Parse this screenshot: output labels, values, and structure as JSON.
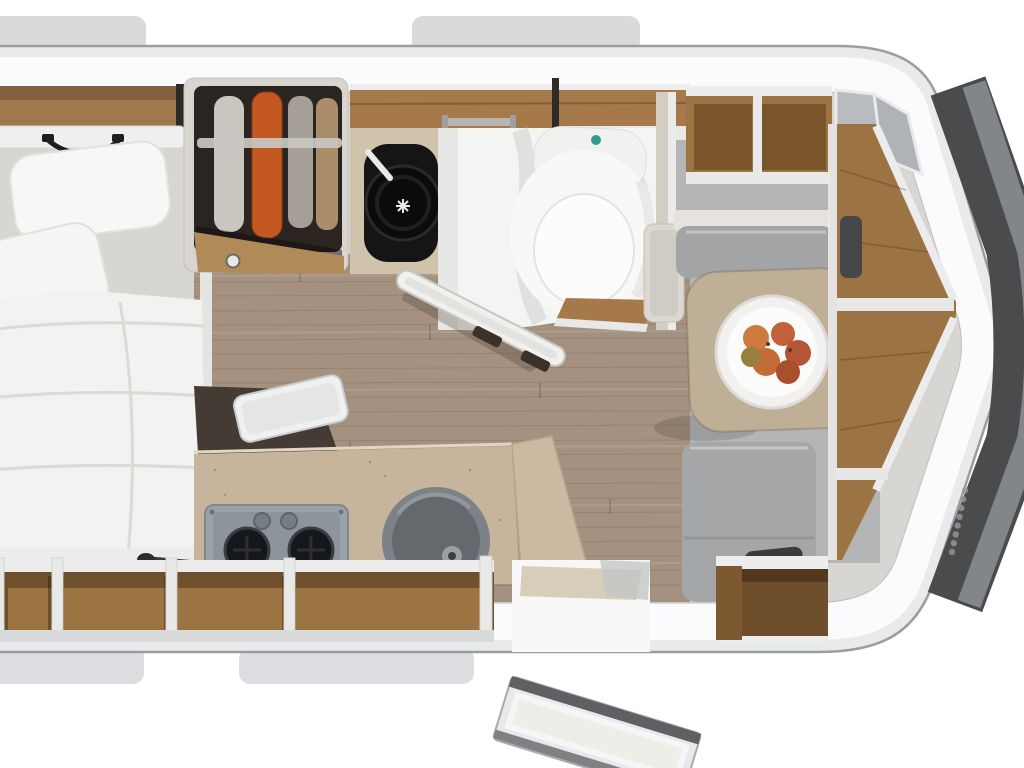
{
  "meta": {
    "title": "Caravan interior floor plan – top-down 3D render",
    "visible_text": "none (only a small illegible vertical brand logo on the front body panel)"
  },
  "palette": {
    "background": "#ffffff",
    "shell_band": "#e9eaec",
    "shell_white": "#fbfbfd",
    "outline": "#9c9da0",
    "wall_base": "#d8d6d2",
    "wood": "#9c7342",
    "wood_dark": "#6f4f2b",
    "wood_band": "#a6794a",
    "floor_wood": "#a5917f",
    "floor_gray": "#b4b5b7",
    "counter": "#c6b59c",
    "cushion_gray": "#a3a4a6",
    "table": "#c0af97",
    "bathroom_white": "#f4f4f2",
    "toilet_button_teal": "#2f9a90",
    "wardrobe_interior": "#2b2522",
    "garment_orange": "#c2571f",
    "heater_black": "#131313",
    "hob_gray": "#9aa2a9",
    "burner_black": "#16171a",
    "sink_gray": "#777d81",
    "window_frame": "#4a4b4d",
    "window_glass": "#85898d",
    "fruit_orange": "#c1603a"
  },
  "furniture": {
    "body_shell": {
      "label": "Caravan body shell, rounded with pointed front nose"
    },
    "roof_tab_top_left": {
      "label": "Roof / window rail segment (top left)"
    },
    "roof_tab_top_right": {
      "label": "Roof / window rail segment (top centre)"
    },
    "roof_tab_bottom_left": {
      "label": "Window frame segment (bottom left)"
    },
    "roof_tab_bottom_right": {
      "label": "Window frame segment (bottom centre)"
    },
    "bed": {
      "label": "Double bed with duvet and two pillows"
    },
    "overhead_cabinet": {
      "label": "Overhead wood cabinet above bed"
    },
    "head_shelf": {
      "label": "Headboard shelf with grab handle"
    },
    "wardrobe": {
      "label": "Open wardrobe with hanging clothes"
    },
    "heater": {
      "label": "Heater / technical compartment"
    },
    "wood_band": {
      "label": "Overhead wood locker above bathroom"
    },
    "bathroom": {
      "label": "Bathroom with shower tray"
    },
    "toilet": {
      "label": "Cassette toilet with flush button"
    },
    "towel_bar": {
      "label": "Towel rail"
    },
    "bathroom_door": {
      "label": "Open bathroom door"
    },
    "kitchen_counter": {
      "label": "Kitchen worktop"
    },
    "worktop_flap": {
      "label": "Folding worktop extension with lid"
    },
    "hob": {
      "label": "Two-burner gas hob"
    },
    "sink": {
      "label": "Round kitchen sink"
    },
    "faucet": {
      "label": "Folded kitchen faucet"
    },
    "base_shelves": {
      "label": "Open base shelves along rear wall"
    },
    "entry_door": {
      "label": "Entrance door, swung open to outside"
    },
    "entry_step": {
      "label": "Entrance threshold"
    },
    "dinette_lockers": {
      "label": "Overhead lockers above dinette"
    },
    "corner_panes": {
      "label": "Frosted corner cabinet panes"
    },
    "bench_front": {
      "label": "Dinette bench (front)"
    },
    "bench_rear": {
      "label": "Dinette bench (rear)"
    },
    "side_cabinet": {
      "label": "Small side cabinet next to table"
    },
    "table": {
      "label": "Dinette table"
    },
    "fruit_bowl": {
      "label": "Bowl of fruit on table"
    },
    "sideboard": {
      "label": "Wood sideboard shelving in nose"
    },
    "rear_locker": {
      "label": "Open locker beside entrance"
    },
    "front_window": {
      "label": "Panoramic dark front window"
    },
    "brand_logo": {
      "label": "Illegible vertical brand logo on body"
    }
  }
}
